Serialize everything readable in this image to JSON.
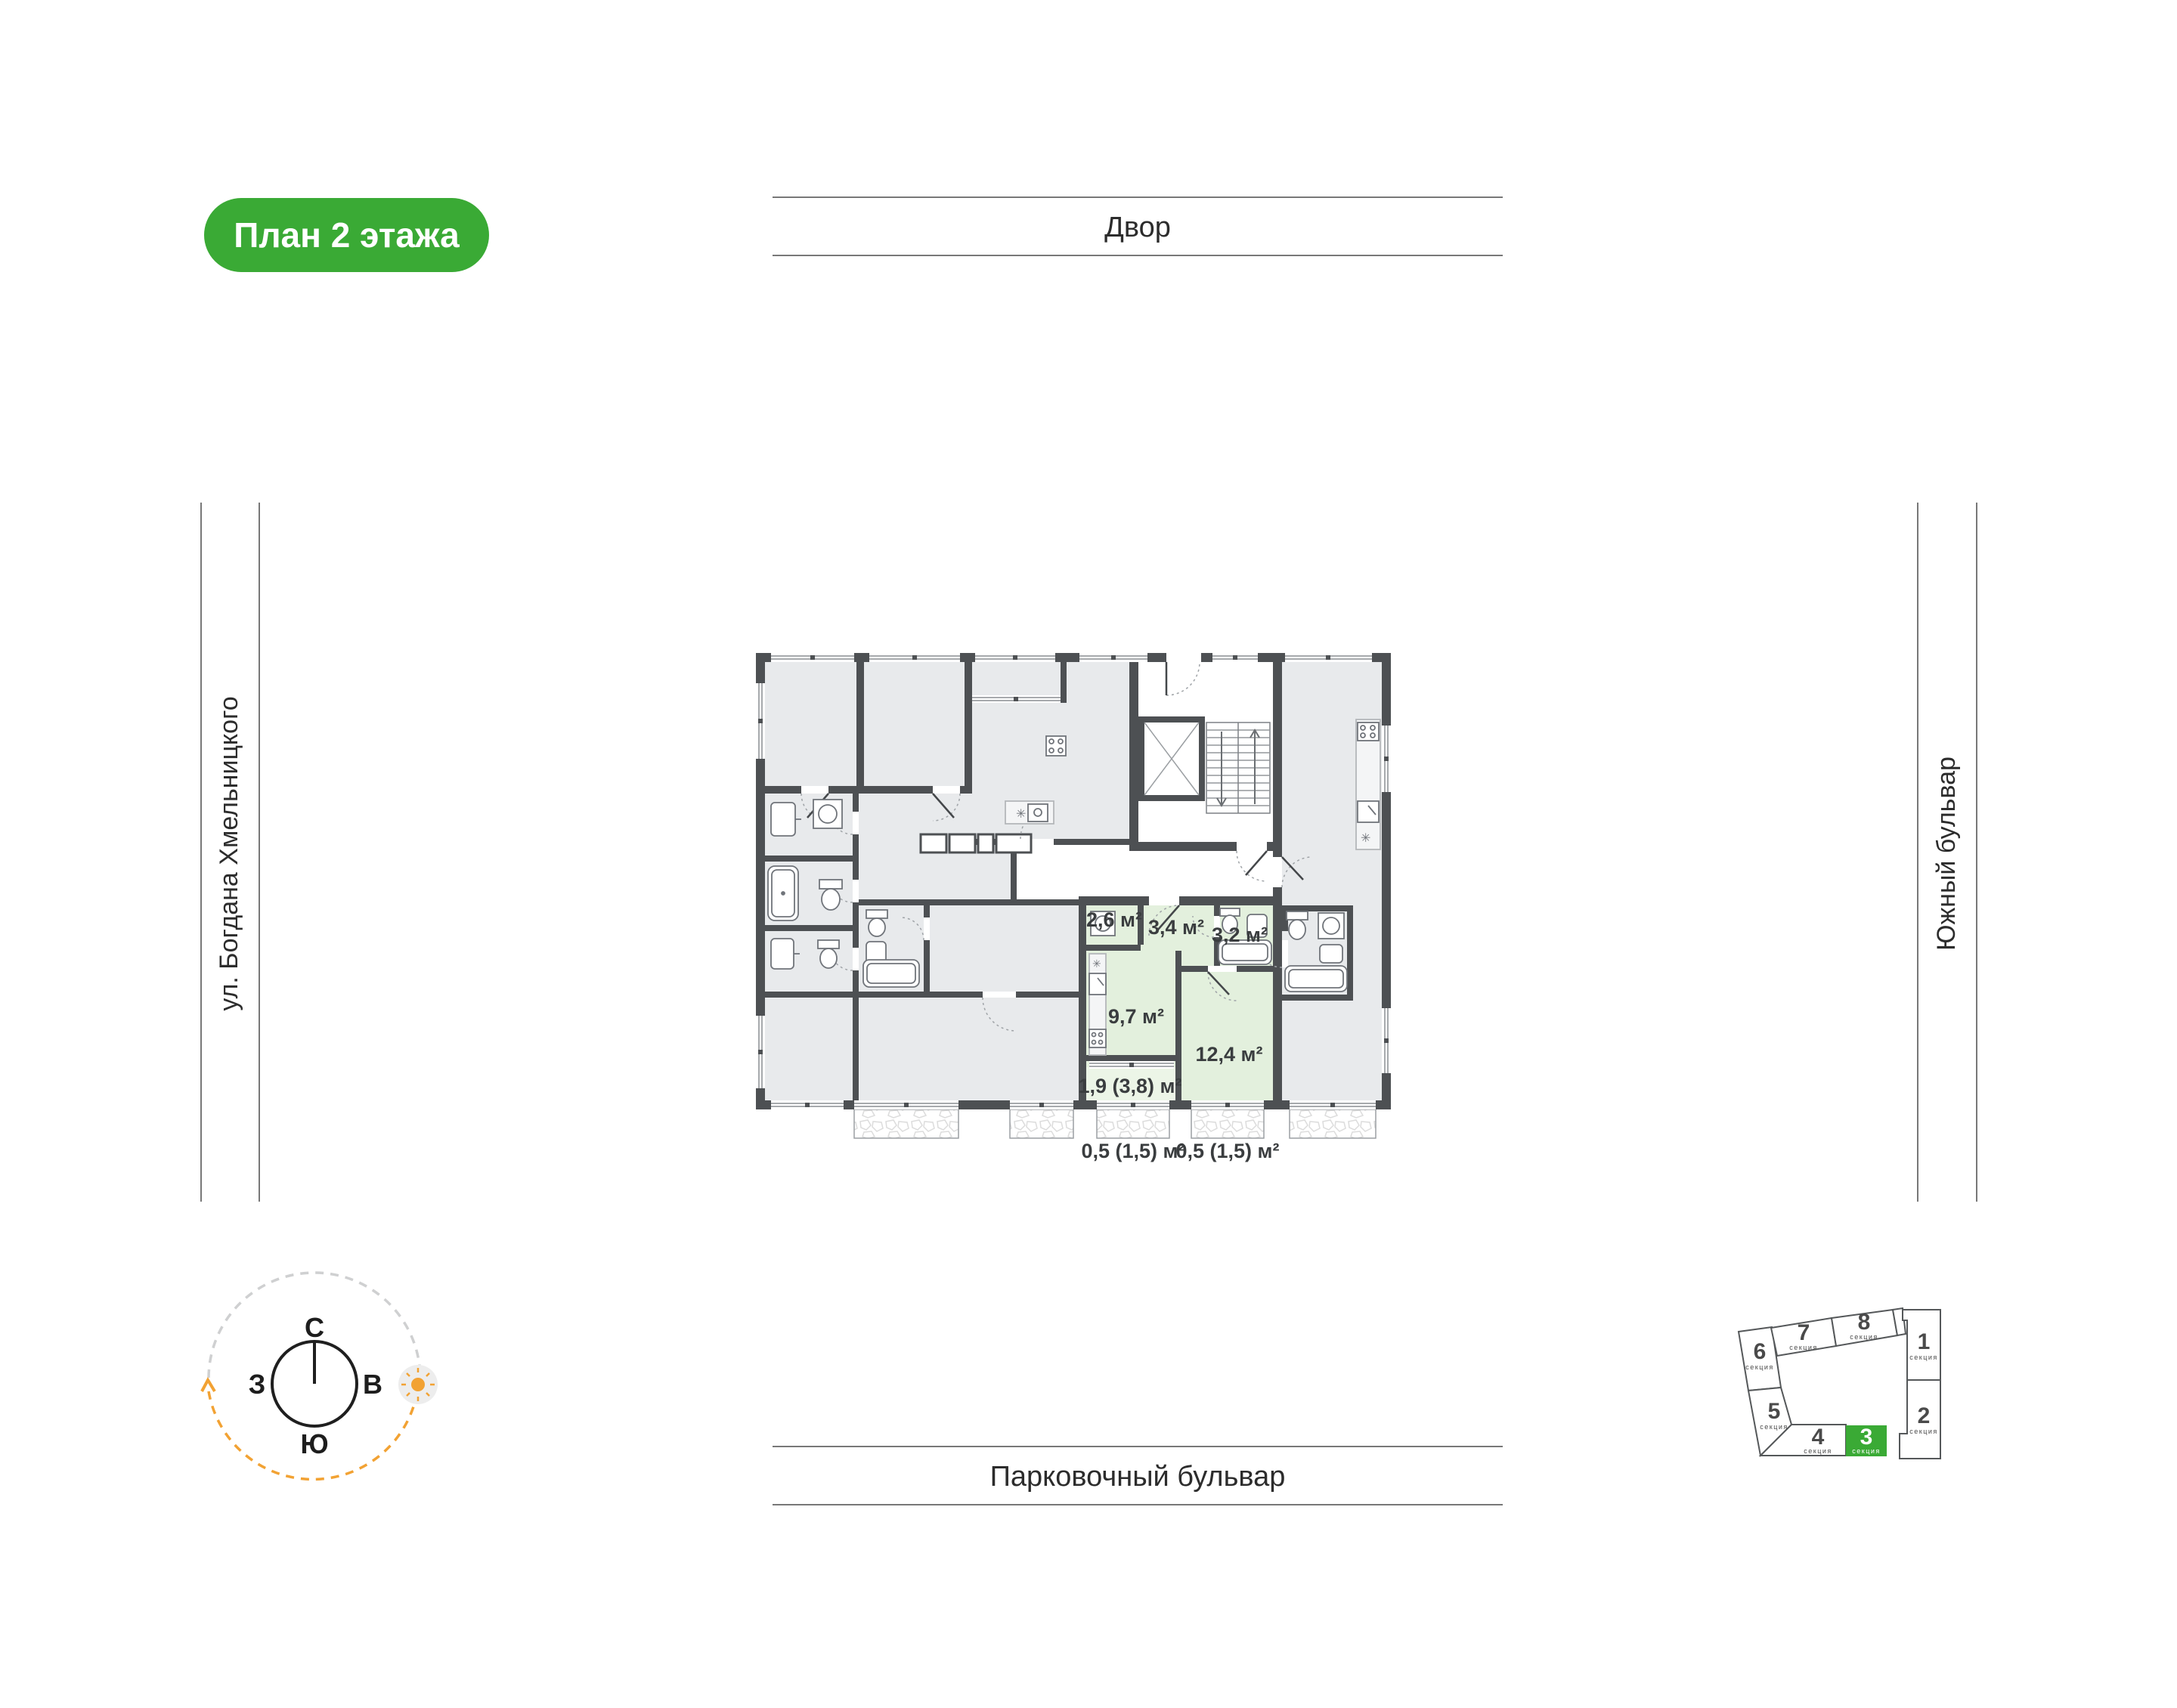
{
  "badge": {
    "label": "План 2 этажа"
  },
  "surroundings": {
    "top": "Двор",
    "bottom": "Парковочный бульвар",
    "left": "ул. Богдана Хмельницкого",
    "right": "Южный бульвар"
  },
  "compass": {
    "north": "С",
    "south": "Ю",
    "west": "З",
    "east": "В"
  },
  "plan": {
    "areas": {
      "r26": "2,6 м²",
      "r34": "3,4 м²",
      "r32": "3,2 м²",
      "r97": "9,7 м²",
      "r124": "12,4 м²",
      "loggia": "1,9 (3,8) м²",
      "balcony_left": "0,5 (1,5) м²",
      "balcony_right": "0,5 (1,5) м²"
    }
  },
  "minimap": {
    "highlighted": "3",
    "sections": [
      {
        "num": "1",
        "label": "секция"
      },
      {
        "num": "2",
        "label": "секция"
      },
      {
        "num": "3",
        "label": "секция"
      },
      {
        "num": "4",
        "label": "секция"
      },
      {
        "num": "5",
        "label": "секция"
      },
      {
        "num": "6",
        "label": "секция"
      },
      {
        "num": "7",
        "label": "секция"
      },
      {
        "num": "8",
        "label": "секция"
      }
    ]
  },
  "colors": {
    "accent_green": "#3aaa35",
    "apartment_green": "#e3f0dd",
    "room_gray": "#e8eaec",
    "wall": "#4d5053",
    "sun_orange": "#f2a233"
  }
}
